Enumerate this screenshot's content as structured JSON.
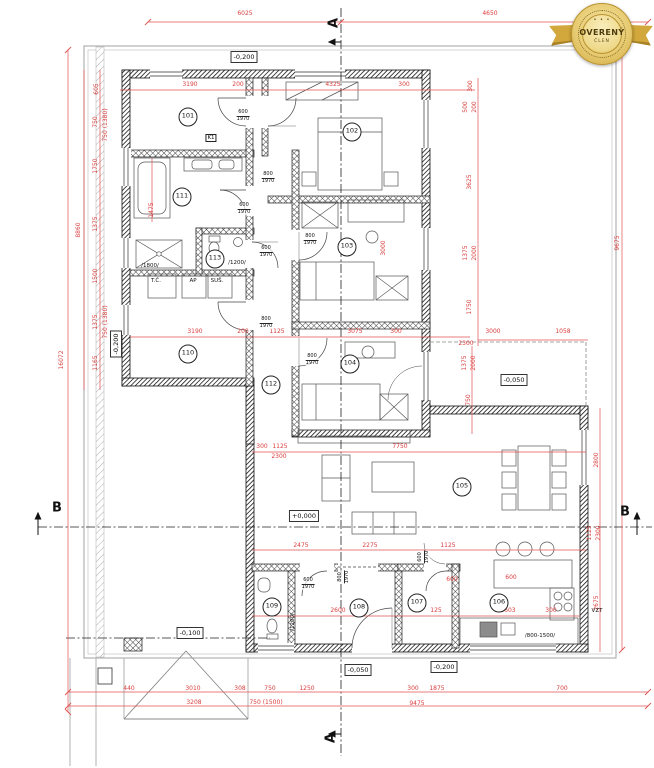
{
  "badge": {
    "dots": "• • •",
    "title": "OVERENÝ",
    "subtitle": "ČLEN"
  },
  "sections": [
    {
      "t": "A",
      "x": 334,
      "y": 23,
      "v": true
    },
    {
      "t": "A",
      "x": 331,
      "y": 738,
      "v": true
    },
    {
      "t": "B",
      "x": 57,
      "y": 508,
      "v": false
    },
    {
      "t": "B",
      "x": 625,
      "y": 512,
      "v": false
    }
  ],
  "rooms": [
    {
      "id": "101",
      "x": 188,
      "y": 117
    },
    {
      "id": "102",
      "x": 352,
      "y": 132
    },
    {
      "id": "103",
      "x": 347,
      "y": 247
    },
    {
      "id": "104",
      "x": 350,
      "y": 364
    },
    {
      "id": "105",
      "x": 462,
      "y": 487
    },
    {
      "id": "106",
      "x": 499,
      "y": 603
    },
    {
      "id": "107",
      "x": 417,
      "y": 603
    },
    {
      "id": "108",
      "x": 359,
      "y": 608
    },
    {
      "id": "109",
      "x": 272,
      "y": 607
    },
    {
      "id": "110",
      "x": 188,
      "y": 354
    },
    {
      "id": "111",
      "x": 182,
      "y": 197
    },
    {
      "id": "112",
      "x": 271,
      "y": 385
    },
    {
      "id": "113",
      "x": 215,
      "y": 259
    }
  ],
  "elevations": [
    {
      "t": "-0,200",
      "x": 244,
      "y": 57,
      "v": false
    },
    {
      "t": "-0,200",
      "x": 116,
      "y": 344,
      "v": true
    },
    {
      "t": "-0,050",
      "x": 514,
      "y": 380,
      "v": false
    },
    {
      "t": "+0,000",
      "x": 304,
      "y": 516,
      "v": false
    },
    {
      "t": "-0,100",
      "x": 190,
      "y": 633,
      "v": false
    },
    {
      "t": "-0,050",
      "x": 358,
      "y": 670,
      "v": false
    },
    {
      "t": "-0,200",
      "x": 444,
      "y": 667,
      "v": false
    }
  ],
  "dims": [
    {
      "t": "6025",
      "x": 245,
      "y": 14
    },
    {
      "t": "4650",
      "x": 490,
      "y": 14
    },
    {
      "t": "3190",
      "x": 190,
      "y": 85
    },
    {
      "t": "200",
      "x": 238,
      "y": 85
    },
    {
      "t": "4325",
      "x": 333,
      "y": 85
    },
    {
      "t": "300",
      "x": 404,
      "y": 85
    },
    {
      "t": "16072",
      "x": 62,
      "y": 360,
      "v": true
    },
    {
      "t": "8860",
      "x": 79,
      "y": 230,
      "v": true
    },
    {
      "t": "605",
      "x": 97,
      "y": 89,
      "v": true
    },
    {
      "t": "750",
      "x": 96,
      "y": 122,
      "v": true
    },
    {
      "t": "1750",
      "x": 96,
      "y": 166,
      "v": true
    },
    {
      "t": "1375",
      "x": 96,
      "y": 224,
      "v": true
    },
    {
      "t": "1500",
      "x": 96,
      "y": 276,
      "v": true
    },
    {
      "t": "1375",
      "x": 96,
      "y": 322,
      "v": true
    },
    {
      "t": "1165",
      "x": 96,
      "y": 363,
      "v": true
    },
    {
      "t": "1475",
      "x": 152,
      "y": 210,
      "v": true
    },
    {
      "t": "9675",
      "x": 618,
      "y": 243,
      "v": true
    },
    {
      "t": "2800",
      "x": 597,
      "y": 460,
      "v": true
    },
    {
      "t": "1125",
      "x": 590,
      "y": 533,
      "v": true
    },
    {
      "t": "2300",
      "x": 599,
      "y": 533,
      "v": true
    },
    {
      "t": "2675",
      "x": 597,
      "y": 603,
      "v": true
    },
    {
      "t": "300",
      "x": 471,
      "y": 86,
      "v": true
    },
    {
      "t": "500",
      "x": 466,
      "y": 107,
      "v": true
    },
    {
      "t": "200",
      "x": 475,
      "y": 107,
      "v": true
    },
    {
      "t": "3625",
      "x": 470,
      "y": 182,
      "v": true
    },
    {
      "t": "1375",
      "x": 466,
      "y": 253,
      "v": true
    },
    {
      "t": "2000",
      "x": 475,
      "y": 253,
      "v": true
    },
    {
      "t": "1750",
      "x": 470,
      "y": 307,
      "v": true
    },
    {
      "t": "3000",
      "x": 493,
      "y": 332
    },
    {
      "t": "1058",
      "x": 563,
      "y": 332
    },
    {
      "t": "2300",
      "x": 466,
      "y": 344
    },
    {
      "t": "1375",
      "x": 465,
      "y": 363,
      "v": true
    },
    {
      "t": "2000",
      "x": 474,
      "y": 363,
      "v": true
    },
    {
      "t": "750",
      "x": 469,
      "y": 400,
      "v": true
    },
    {
      "t": "3190",
      "x": 195,
      "y": 332
    },
    {
      "t": "200",
      "x": 243,
      "y": 332
    },
    {
      "t": "1125",
      "x": 277,
      "y": 332
    },
    {
      "t": "3075",
      "x": 355,
      "y": 332
    },
    {
      "t": "300",
      "x": 396,
      "y": 332
    },
    {
      "t": "3000",
      "x": 384,
      "y": 248,
      "v": true
    },
    {
      "t": "300",
      "x": 262,
      "y": 447
    },
    {
      "t": "1125",
      "x": 280,
      "y": 447
    },
    {
      "t": "2300",
      "x": 279,
      "y": 457
    },
    {
      "t": "7750",
      "x": 400,
      "y": 447
    },
    {
      "t": "2475",
      "x": 301,
      "y": 546
    },
    {
      "t": "2275",
      "x": 370,
      "y": 546
    },
    {
      "t": "1125",
      "x": 448,
      "y": 546
    },
    {
      "t": "2600",
      "x": 338,
      "y": 611
    },
    {
      "t": "125",
      "x": 436,
      "y": 611
    },
    {
      "t": "600",
      "x": 452,
      "y": 580
    },
    {
      "t": "600",
      "x": 511,
      "y": 578
    },
    {
      "t": "3603",
      "x": 508,
      "y": 611
    },
    {
      "t": "300",
      "x": 551,
      "y": 611
    },
    {
      "t": "440",
      "x": 129,
      "y": 689
    },
    {
      "t": "3010",
      "x": 193,
      "y": 689
    },
    {
      "t": "308",
      "x": 240,
      "y": 689
    },
    {
      "t": "750",
      "x": 270,
      "y": 689
    },
    {
      "t": "1250",
      "x": 307,
      "y": 689
    },
    {
      "t": "300",
      "x": 413,
      "y": 689
    },
    {
      "t": "1875",
      "x": 437,
      "y": 689
    },
    {
      "t": "700",
      "x": 562,
      "y": 689
    },
    {
      "t": "3208",
      "x": 194,
      "y": 703
    },
    {
      "t": "750 (1500)",
      "x": 266,
      "y": 703
    },
    {
      "t": "9475",
      "x": 417,
      "y": 704
    },
    {
      "t": "750 (1380)",
      "x": 106,
      "y": 125,
      "v": true
    },
    {
      "t": "750 (1380)",
      "x": 106,
      "y": 322,
      "v": true
    }
  ],
  "door_labels": [
    {
      "top": "600",
      "bot": "1970",
      "x": 243,
      "y": 116
    },
    {
      "top": "600",
      "bot": "1970",
      "x": 244,
      "y": 209
    },
    {
      "top": "600",
      "bot": "1970",
      "x": 266,
      "y": 252
    },
    {
      "top": "600",
      "bot": "1970",
      "x": 308,
      "y": 584
    },
    {
      "top": "600",
      "bot": "1970",
      "x": 424,
      "y": 557,
      "v": true
    },
    {
      "top": "800",
      "bot": "1970",
      "x": 268,
      "y": 178
    },
    {
      "top": "800",
      "bot": "1970",
      "x": 310,
      "y": 240
    },
    {
      "top": "800",
      "bot": "1970",
      "x": 266,
      "y": 323
    },
    {
      "top": "800",
      "bot": "1970",
      "x": 312,
      "y": 360
    },
    {
      "top": "800",
      "bot": "1970",
      "x": 344,
      "y": 577,
      "v": true
    }
  ],
  "annotations": [
    {
      "t": "T.Č.",
      "x": 156,
      "y": 281
    },
    {
      "t": "AP",
      "x": 193,
      "y": 281
    },
    {
      "t": "SUŠ.",
      "x": 217,
      "y": 281
    },
    {
      "t": "VZT",
      "x": 597,
      "y": 611
    },
    {
      "t": "/800-1500/",
      "x": 540,
      "y": 636
    },
    {
      "t": "/1800/",
      "x": 150,
      "y": 266
    },
    {
      "t": "/1200/",
      "x": 237,
      "y": 263
    },
    {
      "t": "/1200/",
      "x": 293,
      "y": 622,
      "v": true
    },
    {
      "t": "K1",
      "x": 211,
      "y": 138,
      "boxed": true
    }
  ]
}
